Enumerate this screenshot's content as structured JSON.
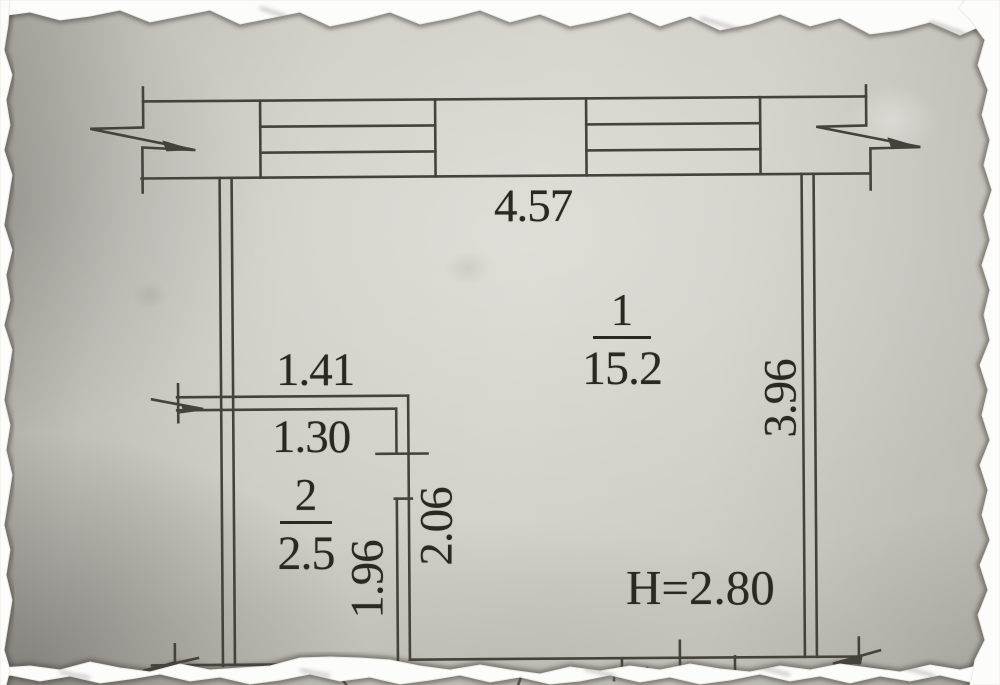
{
  "colors": {
    "ink": "#45423c",
    "text_ink": "#2b2822",
    "tear": "#fcfcfb",
    "paper_light": "#d2cfc8",
    "paper_dark": "#a7a49e"
  },
  "plan": {
    "top_width": "4.57",
    "right_height": "3.96",
    "ceiling_height": "H=2.80",
    "rooms": [
      {
        "number": "1",
        "area": "15.2"
      },
      {
        "number": "2",
        "area": "2.5"
      }
    ],
    "room2": {
      "top_width": "1.41",
      "opening_width": "1.30",
      "inner_height": "1.96",
      "wall_length": "2.06"
    }
  }
}
